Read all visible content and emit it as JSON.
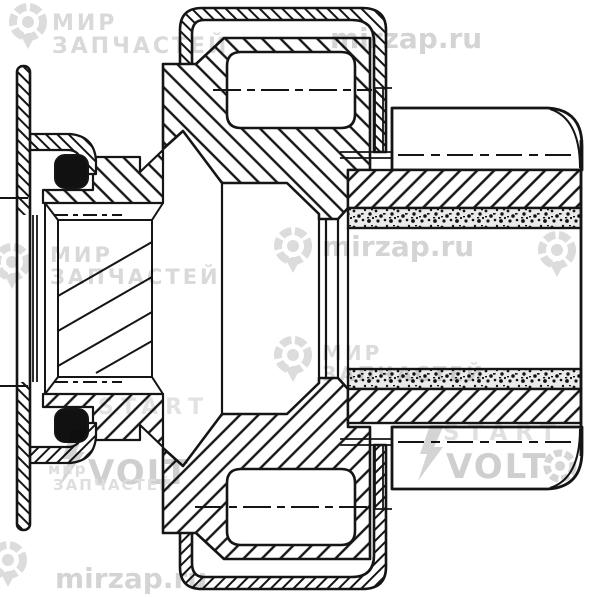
{
  "canvas": {
    "width": 600,
    "height": 597,
    "background": "#ffffff",
    "line_color": "#151515",
    "description": "Black-and-white engineering cross-section drawing of a starter drive (bendix) roller-clutch assembly: left mounting flange plate with rubber seals, central helical-spline bore, clutch housing with two rollers, and pinion barrel with sintered bushings on the right."
  },
  "watermarks": {
    "brand1": {
      "line1": "МИР",
      "line2": "ЗАПЧАСТЕЙ",
      "mir_small": "мир"
    },
    "site": "mirzap.ru",
    "brand2": {
      "start": "START",
      "volt": "VOLT"
    },
    "colors": {
      "text": "#d4d4d4",
      "logo": "#dcdcdc",
      "bold": "#cfcfcf"
    }
  }
}
